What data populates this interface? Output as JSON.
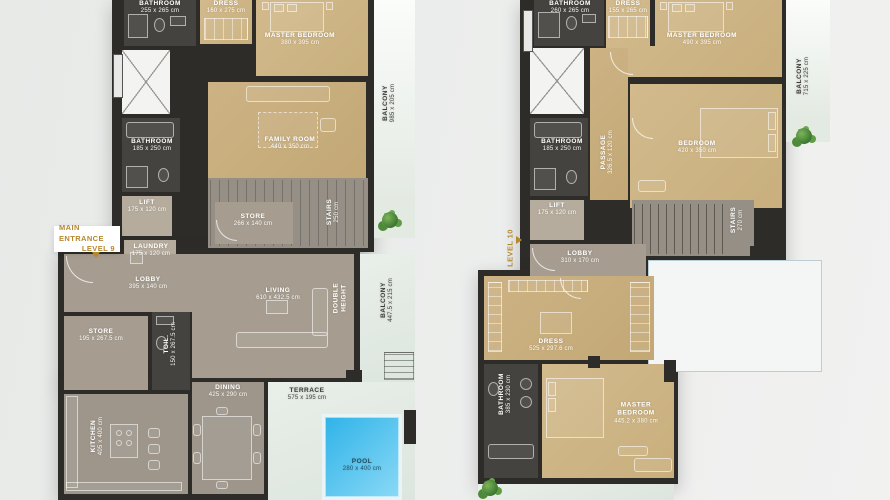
{
  "meta": {
    "type": "residential floor plan",
    "units": "cm"
  },
  "palette": {
    "wall": "#2d2c29",
    "bedroom_tan": "#cdb384",
    "interior_gray": "#a69d90",
    "bathroom_dark": "#45433f",
    "balcony_pale": "#e3eae2",
    "pool_blue": "#2fb3e8",
    "accent_gold": "#b5882e",
    "label_text": "#ffffff",
    "plant_green": "#4e8a3a"
  },
  "level9": {
    "entrance": {
      "line1": "MAIN ENTRANCE",
      "line2": "LEVEL 9"
    },
    "rooms": {
      "bathroom_top": {
        "label": "BATHROOM",
        "dims": "255 x 265 cm"
      },
      "dress": {
        "label": "DRESS",
        "dims": "160 x 275 cm"
      },
      "master_bedroom": {
        "label": "MASTER BEDROOM",
        "dims": "380 x 395 cm"
      },
      "balcony_upper": {
        "label": "BALCONY",
        "dims": "985 x 205 cm"
      },
      "bathroom_mid": {
        "label": "BATHROOM",
        "dims": "185 x 250 cm"
      },
      "family_room": {
        "label": "FAMILY ROOM",
        "dims": "440 x 350 cm"
      },
      "lift": {
        "label": "LIFT",
        "dims": "175 x 120 cm"
      },
      "store_upper": {
        "label": "STORE",
        "dims": "266 x 140 cm"
      },
      "stairs": {
        "label": "STAIRS",
        "dims": "250 cm"
      },
      "laundry": {
        "label": "LAUNDRY",
        "dims": "175 x 120 cm"
      },
      "lobby": {
        "label": "LOBBY",
        "dims": "395 x 140 cm"
      },
      "store_lower": {
        "label": "STORE",
        "dims": "195 x 267.5 cm"
      },
      "toilet": {
        "label": "TOIL.",
        "dims": "150 x 267.5 cm"
      },
      "living": {
        "label": "LIVING",
        "dims": "610 x 432.5 cm"
      },
      "double_height": {
        "label": "DOUBLE HEIGHT",
        "dims": ""
      },
      "balcony_lower": {
        "label": "BALCONY",
        "dims": "447.5 x 215 cm"
      },
      "kitchen": {
        "label": "KITCHEN",
        "dims": "405 x 400 cm"
      },
      "dining": {
        "label": "DINING",
        "dims": "425 x 290 cm"
      },
      "terrace": {
        "label": "TERRACE",
        "dims": "575 x 195 cm"
      },
      "pool": {
        "label": "POOL",
        "dims": "280 x 400 cm"
      }
    }
  },
  "level10": {
    "entrance": {
      "line1": "LEVEL 10"
    },
    "rooms": {
      "bathroom_top": {
        "label": "BATHROOM",
        "dims": "260 x 265 cm"
      },
      "dress_top": {
        "label": "DRESS",
        "dims": "155 x 265 cm"
      },
      "master_bedroom_top": {
        "label": "MASTER BEDROOM",
        "dims": "490 x 395 cm"
      },
      "balcony_upper": {
        "label": "BALCONY",
        "dims": "715 x 225 cm"
      },
      "bathroom_mid": {
        "label": "BATHROOM",
        "dims": "185 x 250 cm"
      },
      "passage": {
        "label": "PASSAGE",
        "dims": "326.5 x 120 cm"
      },
      "bedroom": {
        "label": "BEDROOM",
        "dims": "420 x 350 cm"
      },
      "lift": {
        "label": "LIFT",
        "dims": "175 x 120 cm"
      },
      "stairs": {
        "label": "STAIRS",
        "dims": "270 cm"
      },
      "lobby": {
        "label": "LOBBY",
        "dims": "310 x 170 cm"
      },
      "dress_lower": {
        "label": "DRESS",
        "dims": "525 x 297.6 cm"
      },
      "bathroom_lower": {
        "label": "BATHROOM",
        "dims": "385 x 230 cm"
      },
      "master_bedroom_lower": {
        "label": "MASTER BEDROOM",
        "dims": "445.2 x 380 cm"
      }
    }
  }
}
